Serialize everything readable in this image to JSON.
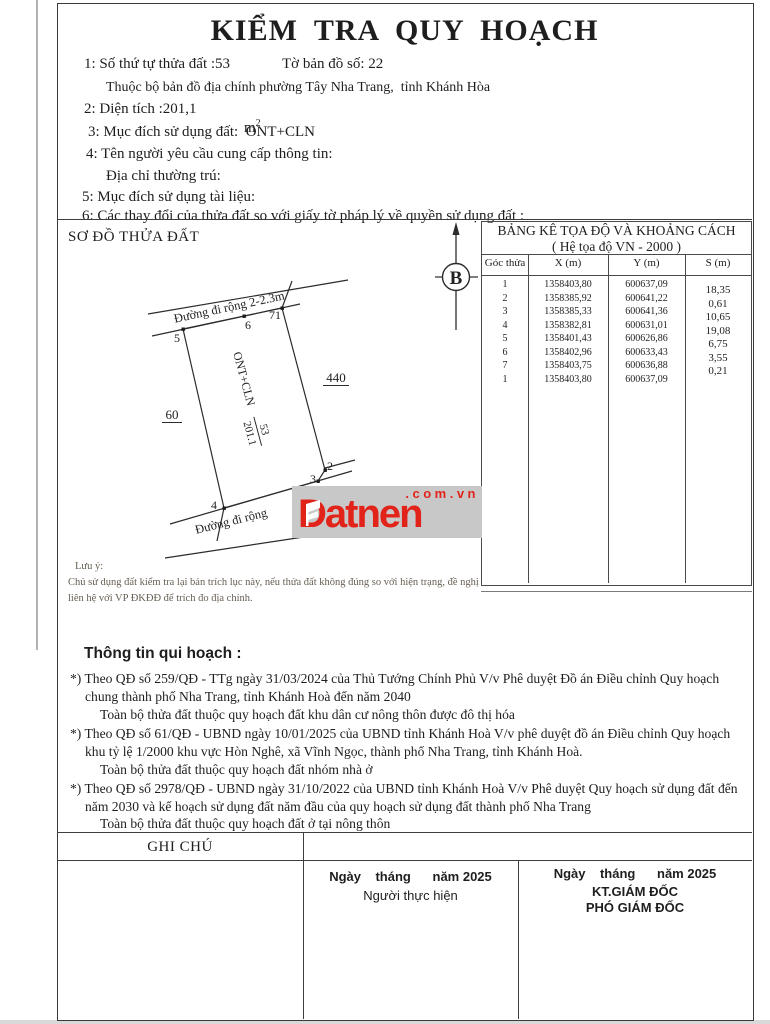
{
  "document": {
    "title": "KIỂM TRA QUY HOẠCH"
  },
  "info": {
    "parcel_number_line": "1: Số thứ tự thửa đất :53",
    "map_sheet": "Tờ bản đồ số: 22",
    "map_belongs": "Thuộc bộ bản đồ địa chính phường Tây Nha Trang,  tỉnh Khánh Hòa",
    "area_line": "2: Diện tích :201,1",
    "area_unit_base": "m",
    "area_unit_sup": "2",
    "land_use": "3: Mục đích sử dụng đất:  ONT+CLN",
    "requester": "4: Tên người yêu cầu cung cấp thông tin:",
    "address": "Địa chỉ thường trú:",
    "doc_purpose": "5: Mục đích sử dụng tài liệu:",
    "changes": "6: Các thay đổi của thửa đất so với giấy tờ pháp lý về quyền sử dụng đất :"
  },
  "diagram": {
    "section_title": "SƠ ĐỒ THỬA ĐẤT",
    "north_label": "B",
    "road_top": "Đường đi rộng 2-2.3m",
    "road_bottom": "Đường đi rộng",
    "use_label": "ONT+CLN",
    "parcel_no": "53",
    "parcel_area": "201.1",
    "adjacent_left": "60",
    "adjacent_right": "440",
    "p5": "5",
    "p6": "6",
    "p71": "71",
    "p2": "2",
    "p3": "3",
    "p4": "4"
  },
  "coord_table": {
    "title_line1": "BẢNG KÊ TỌA ĐỘ VÀ KHOẢNG CÁCH",
    "title_line2": "( Hệ tọa độ VN - 2000 )",
    "col_point": "Góc thửa",
    "col_x": "X (m)",
    "col_y": "Y (m)",
    "col_s": "S (m)",
    "rows": [
      {
        "point": "1",
        "x": "1358403,80",
        "y": "600637,09"
      },
      {
        "point": "2",
        "x": "1358385,92",
        "y": "600641,22"
      },
      {
        "point": "3",
        "x": "1358385,33",
        "y": "600641,36"
      },
      {
        "point": "4",
        "x": "1358382,81",
        "y": "600631,01"
      },
      {
        "point": "5",
        "x": "1358401,43",
        "y": "600626,86"
      },
      {
        "point": "6",
        "x": "1358402,96",
        "y": "600633,43"
      },
      {
        "point": "7",
        "x": "1358403,75",
        "y": "600636,88"
      },
      {
        "point": "1",
        "x": "1358403,80",
        "y": "600637,09"
      }
    ],
    "distances": [
      "18,35",
      "0,61",
      "10,65",
      "19,08",
      "6,75",
      "3,55",
      "0,21"
    ]
  },
  "note": {
    "label": "Lưu ý:",
    "line1": "Chủ sử dụng đất kiểm tra lại bản trích lục này, nếu thửa đất không đúng so với hiện trạng, đề nghị",
    "line2": "liên hệ với VP ĐKĐĐ để trích đo địa chính."
  },
  "planning": {
    "title": "Thông tin qui hoạch :",
    "p1_l1": "*) Theo QĐ số 259/QĐ - TTg ngày 31/03/2024 của Thủ Tướng Chính Phủ V/v Phê duyệt Đồ án Điều chỉnh Quy hoạch",
    "p1_l2": "chung thành phố Nha Trang, tỉnh Khánh Hoà đến năm 2040",
    "p1_l3": "Toàn bộ thửa đất thuộc quy hoạch đất khu dân cư nông thôn được đô thị hóa",
    "p2_l1": "*) Theo QĐ số 61/QĐ - UBND ngày 10/01/2025 của UBND tỉnh Khánh Hoà V/v phê duyệt đồ án Điều chỉnh Quy hoạch",
    "p2_l2": "khu tỷ lệ 1/2000 khu vực Hòn Nghê, xã Vĩnh Ngọc, thành phố Nha Trang, tỉnh Khánh Hoà.",
    "p2_l3": "Toàn bộ thửa đất thuộc quy hoạch đất nhóm nhà ở",
    "p3_l1": "*) Theo QĐ số 2978/QĐ - UBND ngày 31/10/2022 của UBND tỉnh Khánh Hoà V/v Phê duyệt Quy hoạch sử dụng đất đến",
    "p3_l2": "năm 2030 và kế hoạch sử dụng đất năm đầu của quy hoạch sử dụng đất thành phố Nha Trang",
    "p3_l3": "Toàn bộ thửa đất thuộc quy hoạch đất ở tại nông thôn"
  },
  "footer": {
    "note_header": "GHI CHÚ",
    "mid_date": "Ngày    tháng      năm 2025",
    "mid_role": "Người thực hiện",
    "right_date": "Ngày    tháng      năm 2025",
    "right_role1": "KT.GIÁM ĐỐC",
    "right_role2": "PHÓ GIÁM ĐỐC"
  },
  "watermark": {
    "brand": "Datnen",
    "domain": ".com.vn",
    "color": "#e2231a"
  }
}
